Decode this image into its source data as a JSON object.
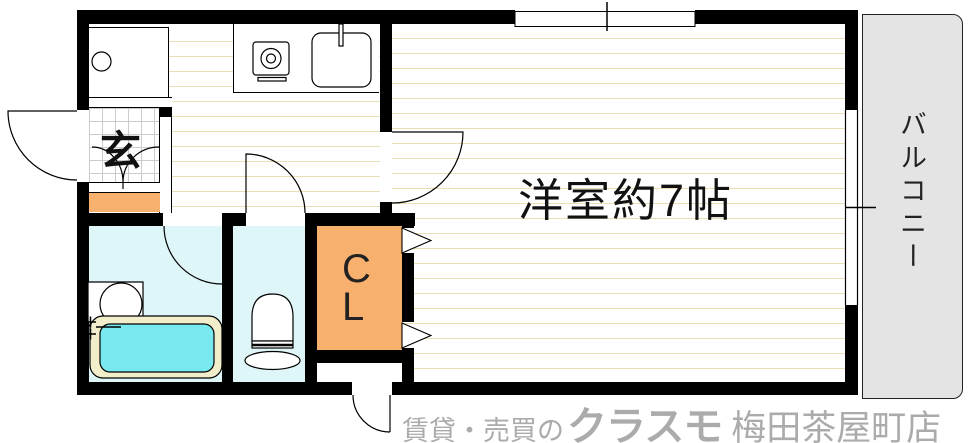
{
  "rooms": {
    "main_room": {
      "label": "洋室約7帖"
    },
    "balcony": {
      "label": "バルコニー"
    },
    "entrance": {
      "label": "玄"
    },
    "closet": {
      "label": "CL"
    }
  },
  "watermark": {
    "prefix": "賃貸・売買の",
    "brand": "クラスモ",
    "store": "梅田茶屋町店"
  },
  "fixtures": [
    "kitchen-stove",
    "kitchen-sink",
    "washing-machine",
    "bathtub",
    "vanity-basin",
    "bath-faucet",
    "toilet",
    "entrance-step",
    "hinged-doors",
    "folding-closet-doors",
    "windows"
  ],
  "colors": {
    "wall": "#000000",
    "floor_line": "#eadfb2",
    "wet_room": "#dff6f9",
    "tub_water": "#79e9f0",
    "tub_rim": "#f2eecb",
    "step_orange": "#f7b06d",
    "balcony_gray": "#e4e4e4",
    "tile_grid": "#cccccc",
    "ink": "#111111",
    "watermark_gray": "#ababab"
  }
}
